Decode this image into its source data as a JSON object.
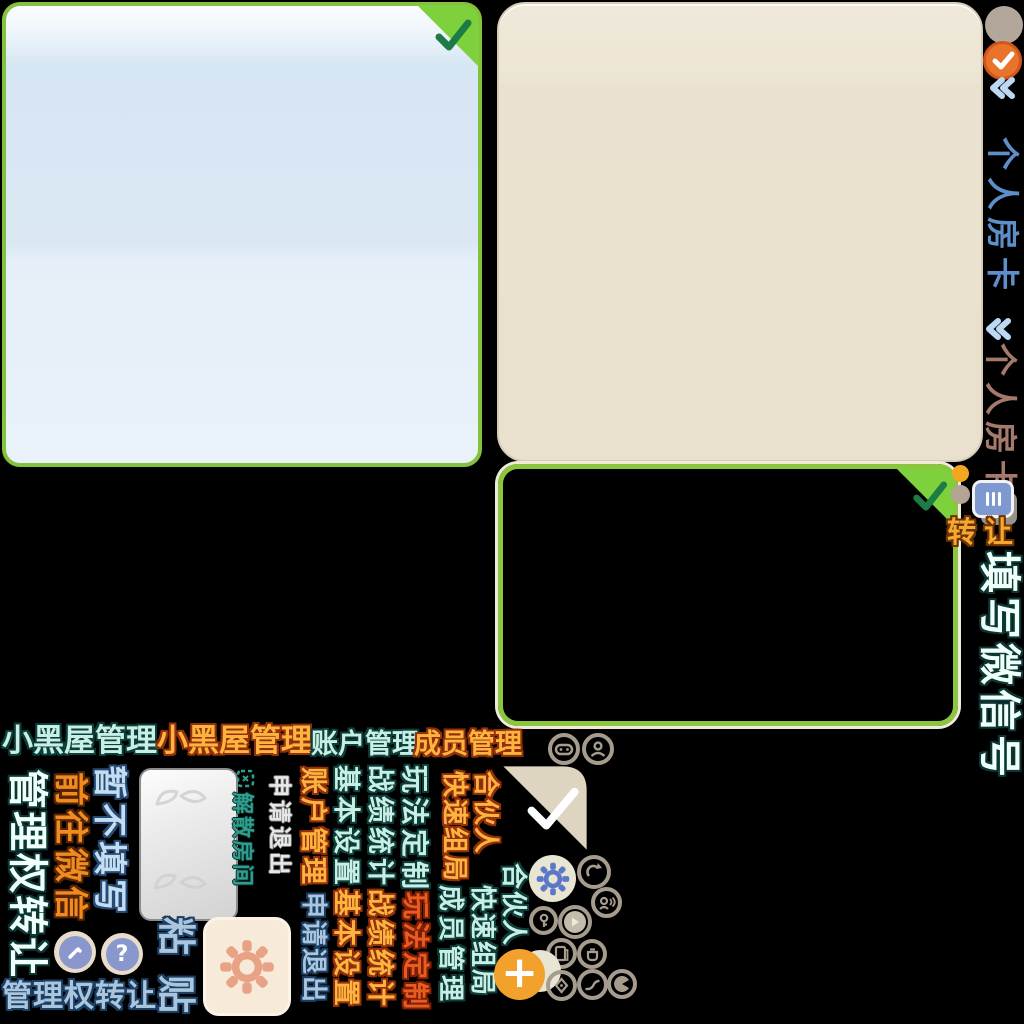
{
  "colors": {
    "background": "#000000",
    "panel_green_border": "#8cc63e",
    "fold_green": "#7ed13c",
    "check_green": "#1d7c45",
    "panel_blue_fill": "#dbe8f4",
    "panel_beige_fill": "#e9e1d0",
    "fold_beige": "#ded5c0",
    "accent_orange": "#e9732a",
    "icon_taupe": "#a59c8e",
    "gear_blue": "#5b78c8",
    "gear_salmon": "#e8a285",
    "plus_orange": "#f2a12d",
    "text_cyan": "#c8efe5",
    "text_orange": "#fdb43e",
    "text_steel": "#a9c6de"
  },
  "right_rail": {
    "room_card_blue": "个人房卡",
    "room_card_taupe": "个人房卡",
    "transfer": "转让",
    "fill_wechat": "填写微信号"
  },
  "menu_row": {
    "blackroom_cyan": "小黑屋管理",
    "blackroom_orange": "小黑屋管理",
    "account_cyan": "账户管理",
    "member_orange": "成员管理"
  },
  "buttons": {
    "mgmt_transfer_vertical": "管理权转让",
    "goto_wechat": "前往微信",
    "skip_fill": "暂不填写",
    "dissolve_room": "解散房间",
    "apply_quit_gray": "申请退出",
    "account_orange": "账户管理",
    "apply_quit_blue": "申请退出",
    "basic_setting_cyan": "基本设置",
    "basic_setting_orange": "基本设置",
    "stats_cyan": "战绩统计",
    "stats_orange": "战绩统计",
    "gameplay_cyan": "玩法定制",
    "gameplay_red": "玩法定制",
    "quick_group_orange": "快速组局",
    "partner_orange": "合伙人",
    "member_cyan": "成员管理",
    "quick_group_cyan": "快速组局",
    "partner_cyan": "合伙人",
    "paste": "粘贴",
    "mgmt_transfer_horizontal": "管理权转让"
  },
  "glyphs": {
    "question": "?",
    "plus": "+"
  },
  "icons": {
    "check-icon": "checkmark",
    "chevron-double-left-icon": "double chevron",
    "room-card-icon": "card with bars",
    "gamepad-icon": "gamepad",
    "member-icon": "person",
    "dissolve-room-icon": "dashed square",
    "edit-icon": "pencil in circle",
    "help-icon": "question mark",
    "gear-icon": "gear",
    "share-icon": "curved arrow",
    "voice-icon": "person with waves",
    "key-icon": "key",
    "play-icon": "play triangle",
    "card-file-icon": "file card",
    "pot-icon": "pot",
    "plus-icon": "plus",
    "diamond-icon": "diamond",
    "trend-icon": "curve",
    "pie-icon": "pie wedge"
  }
}
